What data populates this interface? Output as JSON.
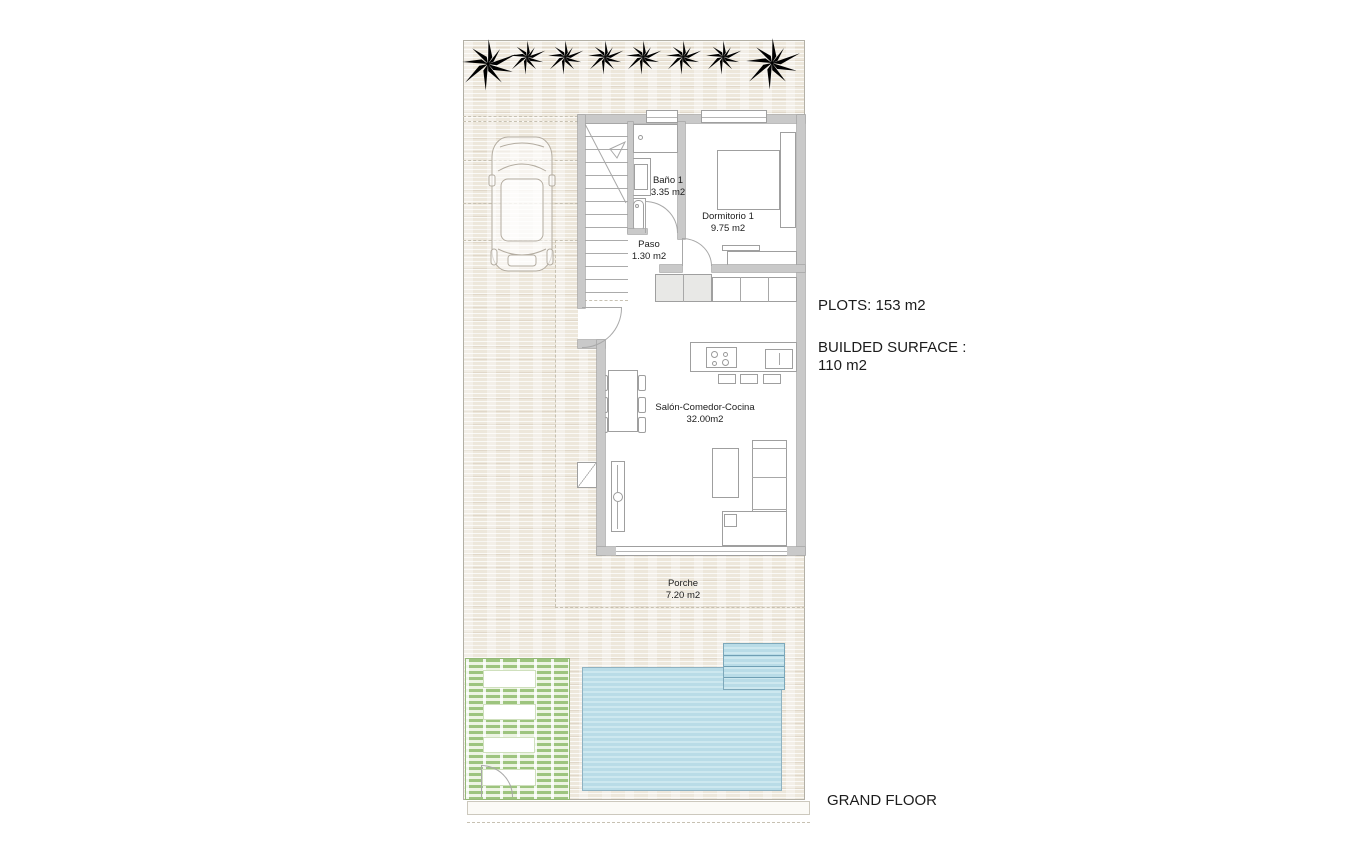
{
  "plan": {
    "rooms": [
      {
        "name": "Baño 1",
        "area": "3.35 m2"
      },
      {
        "name": "Dormitorio 1",
        "area": "9.75 m2"
      },
      {
        "name": "Paso",
        "area": "1.30 m2"
      },
      {
        "name": "Salón-Comedor-Cocina",
        "area": "32.00m2"
      },
      {
        "name": "Porche",
        "area": "7.20 m2"
      }
    ],
    "features": [
      "palm trees",
      "parked car",
      "staircase",
      "swimming pool",
      "garden deck",
      "kitchen island",
      "dining table",
      "sofa",
      "bed"
    ]
  },
  "annotations": {
    "plots": "PLOTS: 153 m2",
    "built_surface_line1": "BUILDED SURFACE :",
    "built_surface_line2": "110 m2",
    "floor_title": "GRAND FLOOR"
  },
  "colors": {
    "palm_green": "#3c8c27",
    "pool_blue": "#b9dce7",
    "garden_green": "#9dc47e",
    "wall_gray": "#c9c9c9"
  }
}
